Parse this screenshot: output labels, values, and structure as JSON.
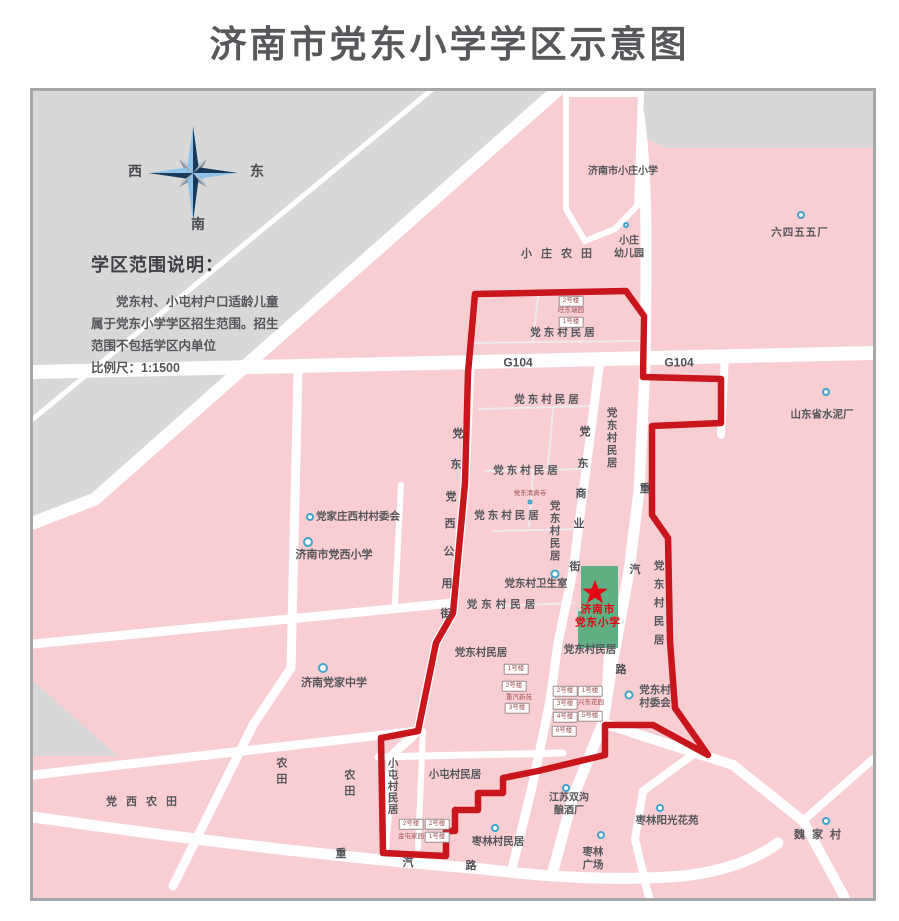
{
  "title": "济南市党东小学学区示意图",
  "compass": {
    "west": "西",
    "east": "东",
    "south": "南"
  },
  "legend": {
    "title": "学区范围说明：",
    "line1": "党东村、小屯村户口适龄儿童",
    "line2": "属于党东小学学区招生范围。招生",
    "line3": "范围不包括学区内单位",
    "line4": "比例尺：1:1500"
  },
  "colors": {
    "district_pink": "#f8ced3",
    "outside_gray": "#d8d8d9",
    "road_white": "#ffffff",
    "boundary_red": "#c9161c",
    "school_green": "#5fae84",
    "marker_blue": "#3fa3cc",
    "star_red": "#e60012",
    "text_gray": "#55565a"
  },
  "map": {
    "labels": [
      {
        "name": "label-xiaozhuang-primary",
        "text": "济南市小庄小学",
        "x": 590,
        "y": 81,
        "fs": 10
      },
      {
        "name": "label-xiaozhuang-kindergarten",
        "text": "小庄\n幼儿园",
        "x": 596,
        "y": 157,
        "fs": 10
      },
      {
        "name": "label-645-factory",
        "text": "六四五五厂",
        "x": 767,
        "y": 142,
        "fs": 10.5,
        "ls": 1
      },
      {
        "name": "label-xiaozhuang-farmland",
        "text": "小庄农田",
        "x": 528,
        "y": 164,
        "fs": 11,
        "ls": 9
      },
      {
        "name": "label-dangdong-residences-1",
        "text": "党东村民居",
        "x": 531,
        "y": 242,
        "fs": 10.5,
        "ls": 3
      },
      {
        "name": "label-g104-west",
        "text": "G104",
        "x": 485,
        "y": 272,
        "fs": 12,
        "kind": "road"
      },
      {
        "name": "label-g104-east",
        "text": "G104",
        "x": 646,
        "y": 272,
        "fs": 12,
        "kind": "road"
      },
      {
        "name": "label-dangdong-residences-2",
        "text": "党东村民居",
        "x": 515,
        "y": 309,
        "fs": 10.5,
        "ls": 3
      },
      {
        "name": "label-dangdong-residences-3",
        "text": "党东村民居",
        "x": 494,
        "y": 380,
        "fs": 10.5,
        "ls": 3
      },
      {
        "name": "label-dangdong-mosque",
        "text": "党东清真寺",
        "x": 497,
        "y": 403,
        "kind": "tiny"
      },
      {
        "name": "label-dangdong-residences-4",
        "text": "党东村民居",
        "x": 475,
        "y": 425,
        "fs": 10.5,
        "ls": 3
      },
      {
        "name": "label-dangdong-clinic",
        "text": "党东村卫生室",
        "x": 503,
        "y": 493,
        "fs": 10.5
      },
      {
        "name": "label-dangdong-residences-5",
        "text": "党东村民居",
        "x": 470,
        "y": 514,
        "fs": 10.5,
        "ls": 4
      },
      {
        "name": "label-dangdong-residences-6",
        "text": "党东村民居",
        "x": 557,
        "y": 559,
        "fs": 10.5
      },
      {
        "name": "label-dangdong-residences-7",
        "text": "党东村民居",
        "x": 448,
        "y": 562,
        "fs": 10.5
      },
      {
        "name": "label-zhongqi-xinyuan",
        "text": "重汽新苑",
        "x": 486,
        "y": 607,
        "kind": "tiny"
      },
      {
        "name": "label-xingdong-garden",
        "text": "兴东花园",
        "x": 558,
        "y": 612,
        "kind": "tiny"
      },
      {
        "name": "label-wangdong-garden",
        "text": "旺东瑞园",
        "x": 538,
        "y": 220,
        "kind": "tiny"
      },
      {
        "name": "label-dangdong-committee",
        "text": "党东村\n村委会",
        "x": 622,
        "y": 606,
        "fs": 10.5
      },
      {
        "name": "label-cement-factory",
        "text": "山东省水泥厂",
        "x": 789,
        "y": 324,
        "fs": 10.5
      },
      {
        "name": "label-dangjiazhuang-west-committee",
        "text": "党家庄西村村委会",
        "x": 325,
        "y": 426,
        "fs": 10.5
      },
      {
        "name": "label-dangxi-primary",
        "text": "济南市党西小学",
        "x": 301,
        "y": 465,
        "fs": 11
      },
      {
        "name": "label-dangjia-middle",
        "text": "济南党家中学",
        "x": 301,
        "y": 593,
        "fs": 11
      },
      {
        "name": "label-dangxi-farmland",
        "text": "党西农田",
        "x": 113,
        "y": 712,
        "fs": 11,
        "ls": 9
      },
      {
        "name": "label-xiaotun-residences",
        "text": "小屯村民居",
        "x": 422,
        "y": 684,
        "fs": 10.5
      },
      {
        "name": "label-jintun-jiayuan",
        "text": "金屯家园",
        "x": 378,
        "y": 746,
        "kind": "tiny"
      },
      {
        "name": "label-zaolin-residences",
        "text": "枣林村民居",
        "x": 465,
        "y": 751,
        "fs": 10.5
      },
      {
        "name": "label-jiangsu-winery",
        "text": "江苏双沟\n酿酒厂",
        "x": 536,
        "y": 714,
        "fs": 10
      },
      {
        "name": "label-zaolin-square",
        "text": "枣林\n广场",
        "x": 560,
        "y": 768,
        "fs": 10.5
      },
      {
        "name": "label-zaolin-sunshine",
        "text": "枣林阳光花苑",
        "x": 634,
        "y": 730,
        "fs": 10.5
      },
      {
        "name": "label-weijia-village",
        "text": "魏家村",
        "x": 788,
        "y": 745,
        "fs": 11,
        "ls": 7
      },
      {
        "name": "label-dangdong-residences-v1",
        "text": "党东村民居",
        "x": 578,
        "y": 347,
        "fs": 10.5,
        "ls": 2,
        "kind": "v"
      },
      {
        "name": "label-dangdong-residences-v2",
        "text": "党东村民居",
        "x": 521,
        "y": 440,
        "fs": 10.5,
        "ls": 2,
        "kind": "v"
      },
      {
        "name": "label-dangdong-residences-v3",
        "text": "党东村民居",
        "x": 625,
        "y": 515,
        "fs": 10.5,
        "ls": 8,
        "kind": "v"
      },
      {
        "name": "label-xiaotun-residences-v",
        "text": "小屯村民居",
        "x": 359,
        "y": 695,
        "fs": 10.5,
        "ls": 1,
        "kind": "v"
      },
      {
        "name": "label-farmland-v1",
        "text": "农田",
        "x": 247,
        "y": 682,
        "fs": 11,
        "ls": 5,
        "kind": "v"
      },
      {
        "name": "label-farmland-v2",
        "text": "农田",
        "x": 315,
        "y": 694,
        "fs": 11,
        "ls": 5,
        "kind": "v"
      },
      {
        "name": "road-char-gongyong-1",
        "text": "党",
        "x": 425,
        "y": 344,
        "kind": "road"
      },
      {
        "name": "road-char-gongyong-2",
        "text": "东",
        "x": 423,
        "y": 375,
        "kind": "road"
      },
      {
        "name": "road-char-gongyong-3",
        "text": "党",
        "x": 418,
        "y": 407,
        "kind": "road"
      },
      {
        "name": "road-char-gongyong-4",
        "text": "西",
        "x": 417,
        "y": 434,
        "kind": "road"
      },
      {
        "name": "road-char-gongyong-5",
        "text": "公",
        "x": 416,
        "y": 462,
        "kind": "road"
      },
      {
        "name": "road-char-gongyong-6",
        "text": "用",
        "x": 414,
        "y": 494,
        "kind": "road"
      },
      {
        "name": "road-char-gongyong-7",
        "text": "街",
        "x": 413,
        "y": 524,
        "kind": "road"
      },
      {
        "name": "road-char-shangye-1",
        "text": "党",
        "x": 552,
        "y": 342,
        "kind": "road"
      },
      {
        "name": "road-char-shangye-2",
        "text": "东",
        "x": 550,
        "y": 374,
        "kind": "road"
      },
      {
        "name": "road-char-shangye-3",
        "text": "商",
        "x": 548,
        "y": 404,
        "kind": "road"
      },
      {
        "name": "road-char-shangye-4",
        "text": "业",
        "x": 546,
        "y": 434,
        "kind": "road"
      },
      {
        "name": "road-char-shangye-5",
        "text": "街",
        "x": 542,
        "y": 477,
        "kind": "road"
      },
      {
        "name": "road-char-zhongqi-e1",
        "text": "重",
        "x": 612,
        "y": 399,
        "kind": "road"
      },
      {
        "name": "road-char-zhongqi-e2",
        "text": "汽",
        "x": 602,
        "y": 480,
        "kind": "road"
      },
      {
        "name": "road-char-zhongqi-e3",
        "text": "路",
        "x": 588,
        "y": 580,
        "kind": "road"
      },
      {
        "name": "road-char-zhongqi-s1",
        "text": "重",
        "x": 308,
        "y": 764,
        "kind": "road"
      },
      {
        "name": "road-char-zhongqi-s2",
        "text": "汽",
        "x": 375,
        "y": 773,
        "kind": "road"
      },
      {
        "name": "road-char-zhongqi-s3",
        "text": "路",
        "x": 438,
        "y": 776,
        "kind": "road"
      },
      {
        "name": "building-box-2",
        "text": "2号楼",
        "x": 538,
        "y": 210,
        "kind": "box"
      },
      {
        "name": "building-box-1",
        "text": "1号楼",
        "x": 538,
        "y": 231,
        "kind": "box"
      },
      {
        "name": "building-box-zq1",
        "text": "1号楼",
        "x": 483,
        "y": 578,
        "kind": "box"
      },
      {
        "name": "building-box-zq2",
        "text": "2号楼",
        "x": 481,
        "y": 595,
        "kind": "box"
      },
      {
        "name": "building-box-zq3",
        "text": "3号楼",
        "x": 484,
        "y": 617,
        "kind": "box"
      },
      {
        "name": "building-box-xd2",
        "text": "2号楼",
        "x": 532,
        "y": 600,
        "kind": "box"
      },
      {
        "name": "building-box-xd3",
        "text": "3号楼",
        "x": 532,
        "y": 613,
        "kind": "box"
      },
      {
        "name": "building-box-xd4",
        "text": "4号楼",
        "x": 532,
        "y": 626,
        "kind": "box"
      },
      {
        "name": "building-box-xd6",
        "text": "6号楼",
        "x": 531,
        "y": 640,
        "kind": "box"
      },
      {
        "name": "building-box-xd1",
        "text": "1号楼",
        "x": 557,
        "y": 600,
        "kind": "box"
      },
      {
        "name": "building-box-xd5",
        "text": "5号楼",
        "x": 557,
        "y": 625,
        "kind": "box"
      },
      {
        "name": "building-box-jt2a",
        "text": "2号楼",
        "x": 378,
        "y": 733,
        "kind": "box"
      },
      {
        "name": "building-box-jt2b",
        "text": "2号楼",
        "x": 404,
        "y": 733,
        "kind": "box"
      },
      {
        "name": "building-box-jt1",
        "text": "1号楼",
        "x": 404,
        "y": 746,
        "kind": "box"
      },
      {
        "name": "school-name-line1",
        "text": "济南市",
        "x": 565,
        "y": 519,
        "kind": "school"
      },
      {
        "name": "school-name-line2",
        "text": "党东小学",
        "x": 565,
        "y": 532,
        "kind": "school"
      }
    ],
    "markers": [
      {
        "name": "poi-xiaozhuang-kindergarten",
        "x": 593,
        "y": 134,
        "r": 3
      },
      {
        "name": "poi-645-factory",
        "x": 768,
        "y": 124,
        "r": 4
      },
      {
        "name": "poi-mosque",
        "x": 497,
        "y": 411,
        "r": 2.5
      },
      {
        "name": "poi-clinic",
        "x": 522,
        "y": 483,
        "r": 4.5
      },
      {
        "name": "poi-dangdong-committee",
        "x": 596,
        "y": 604,
        "r": 4.5
      },
      {
        "name": "poi-cement-factory",
        "x": 793,
        "y": 301,
        "r": 4
      },
      {
        "name": "poi-dangjiazhuang-committee",
        "x": 277,
        "y": 426,
        "r": 4
      },
      {
        "name": "poi-dangxi-primary",
        "x": 275,
        "y": 451,
        "r": 5
      },
      {
        "name": "poi-dangjia-middle",
        "x": 290,
        "y": 577,
        "r": 5
      },
      {
        "name": "poi-zaolin-residences",
        "x": 462,
        "y": 737,
        "r": 4
      },
      {
        "name": "poi-winery",
        "x": 533,
        "y": 697,
        "r": 4
      },
      {
        "name": "poi-zaolin-square",
        "x": 568,
        "y": 744,
        "r": 4
      },
      {
        "name": "poi-zaolin-sunshine",
        "x": 627,
        "y": 717,
        "r": 4
      },
      {
        "name": "poi-weijia",
        "x": 793,
        "y": 730,
        "r": 4
      }
    ]
  }
}
